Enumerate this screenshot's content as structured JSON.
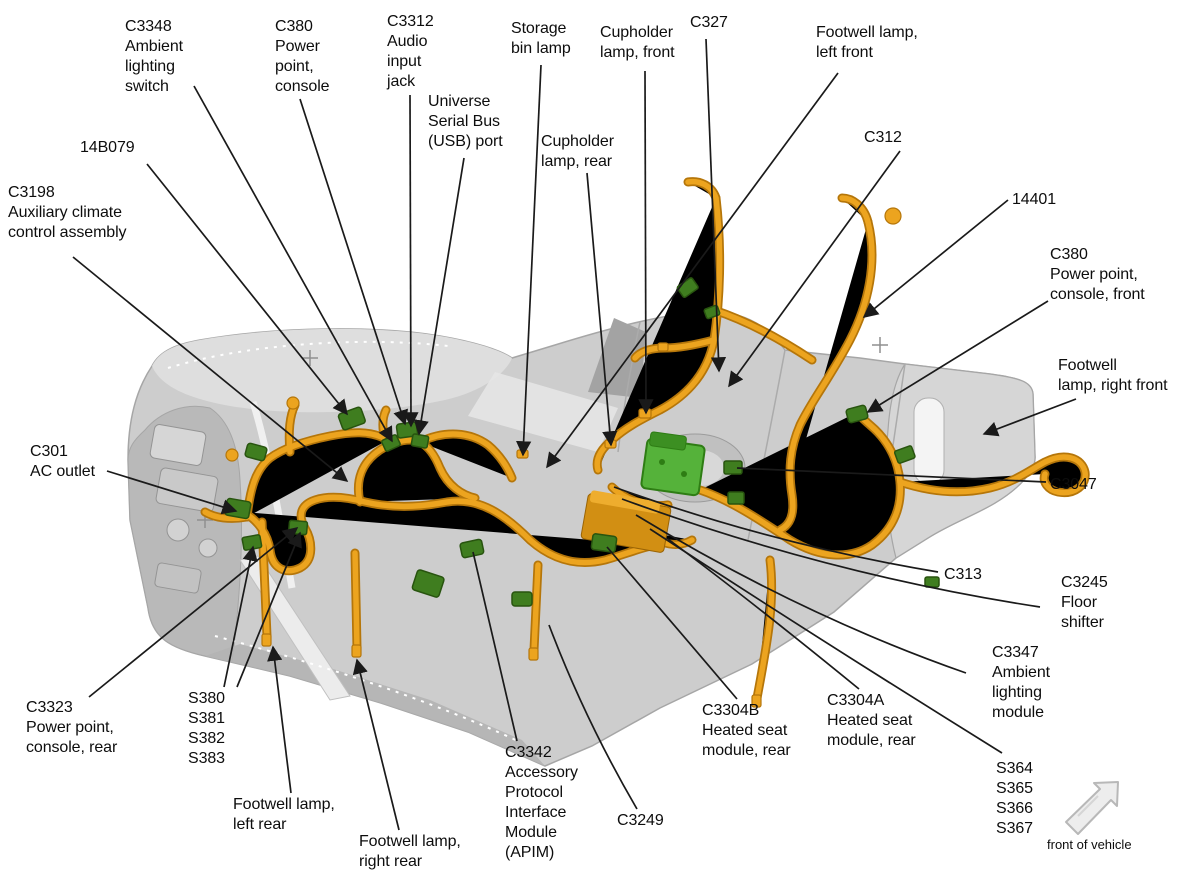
{
  "figure_type": "wiring-harness-callout-diagram",
  "colors": {
    "line": "#1a1a1a",
    "harness": "#eca41f",
    "harness_dark": "#b5760a",
    "connector": "#3f7d1f",
    "connector_dark": "#28540f",
    "connector_bright": "#55b23a",
    "console": "#cdcdcd",
    "console_light": "#dedede",
    "console_dark": "#b9b9b9",
    "console_edge": "#a6a6a6",
    "arrow_fill": "#ededed"
  },
  "callouts": [
    {
      "id": "c3348",
      "text": "C3348\nAmbient\nlighting\nswitch"
    },
    {
      "id": "c380-console",
      "text": "C380\nPower\npoint,\nconsole"
    },
    {
      "id": "c3312",
      "text": "C3312\nAudio\ninput\njack"
    },
    {
      "id": "usb-port",
      "text": "Universe\nSerial Bus\n(USB) port"
    },
    {
      "id": "storage-bin-lamp",
      "text": "Storage\nbin lamp"
    },
    {
      "id": "cupholder-lamp-front",
      "text": "Cupholder\nlamp, front"
    },
    {
      "id": "c327",
      "text": "C327"
    },
    {
      "id": "footwell-lamp-left-front",
      "text": "Footwell lamp,\nleft front"
    },
    {
      "id": "cupholder-lamp-rear",
      "text": "Cupholder\nlamp, rear"
    },
    {
      "id": "14b079",
      "text": "14B079"
    },
    {
      "id": "c3198",
      "text": "C3198\nAuxiliary climate\ncontrol assembly"
    },
    {
      "id": "c312",
      "text": "C312"
    },
    {
      "id": "14401",
      "text": "14401"
    },
    {
      "id": "c380-console-front",
      "text": "C380\nPower point,\nconsole, front"
    },
    {
      "id": "footwell-lamp-right-front",
      "text": "Footwell\nlamp, right front"
    },
    {
      "id": "c301",
      "text": "C301\nAC outlet"
    },
    {
      "id": "c3047",
      "text": "C3047"
    },
    {
      "id": "c313",
      "text": "C313"
    },
    {
      "id": "c3245",
      "text": "C3245\nFloor\nshifter"
    },
    {
      "id": "c3347",
      "text": "C3347\nAmbient\nlighting\nmodule"
    },
    {
      "id": "c3323",
      "text": "C3323\nPower point,\nconsole, rear"
    },
    {
      "id": "s380-group",
      "text": "S380\nS381\nS382\nS383"
    },
    {
      "id": "footwell-lamp-left-rear",
      "text": "Footwell lamp,\nleft rear"
    },
    {
      "id": "footwell-lamp-right-rear",
      "text": "Footwell lamp,\nright rear"
    },
    {
      "id": "c3342",
      "text": "C3342\nAccessory\nProtocol\nInterface\nModule\n(APIM)"
    },
    {
      "id": "c3249",
      "text": "C3249"
    },
    {
      "id": "c3304b",
      "text": "C3304B\nHeated seat\nmodule, rear"
    },
    {
      "id": "c3304a",
      "text": "C3304A\nHeated seat\nmodule, rear"
    },
    {
      "id": "s364-group",
      "text": "S364\nS365\nS366\nS367"
    }
  ],
  "orientation": {
    "label": "front of vehicle"
  }
}
